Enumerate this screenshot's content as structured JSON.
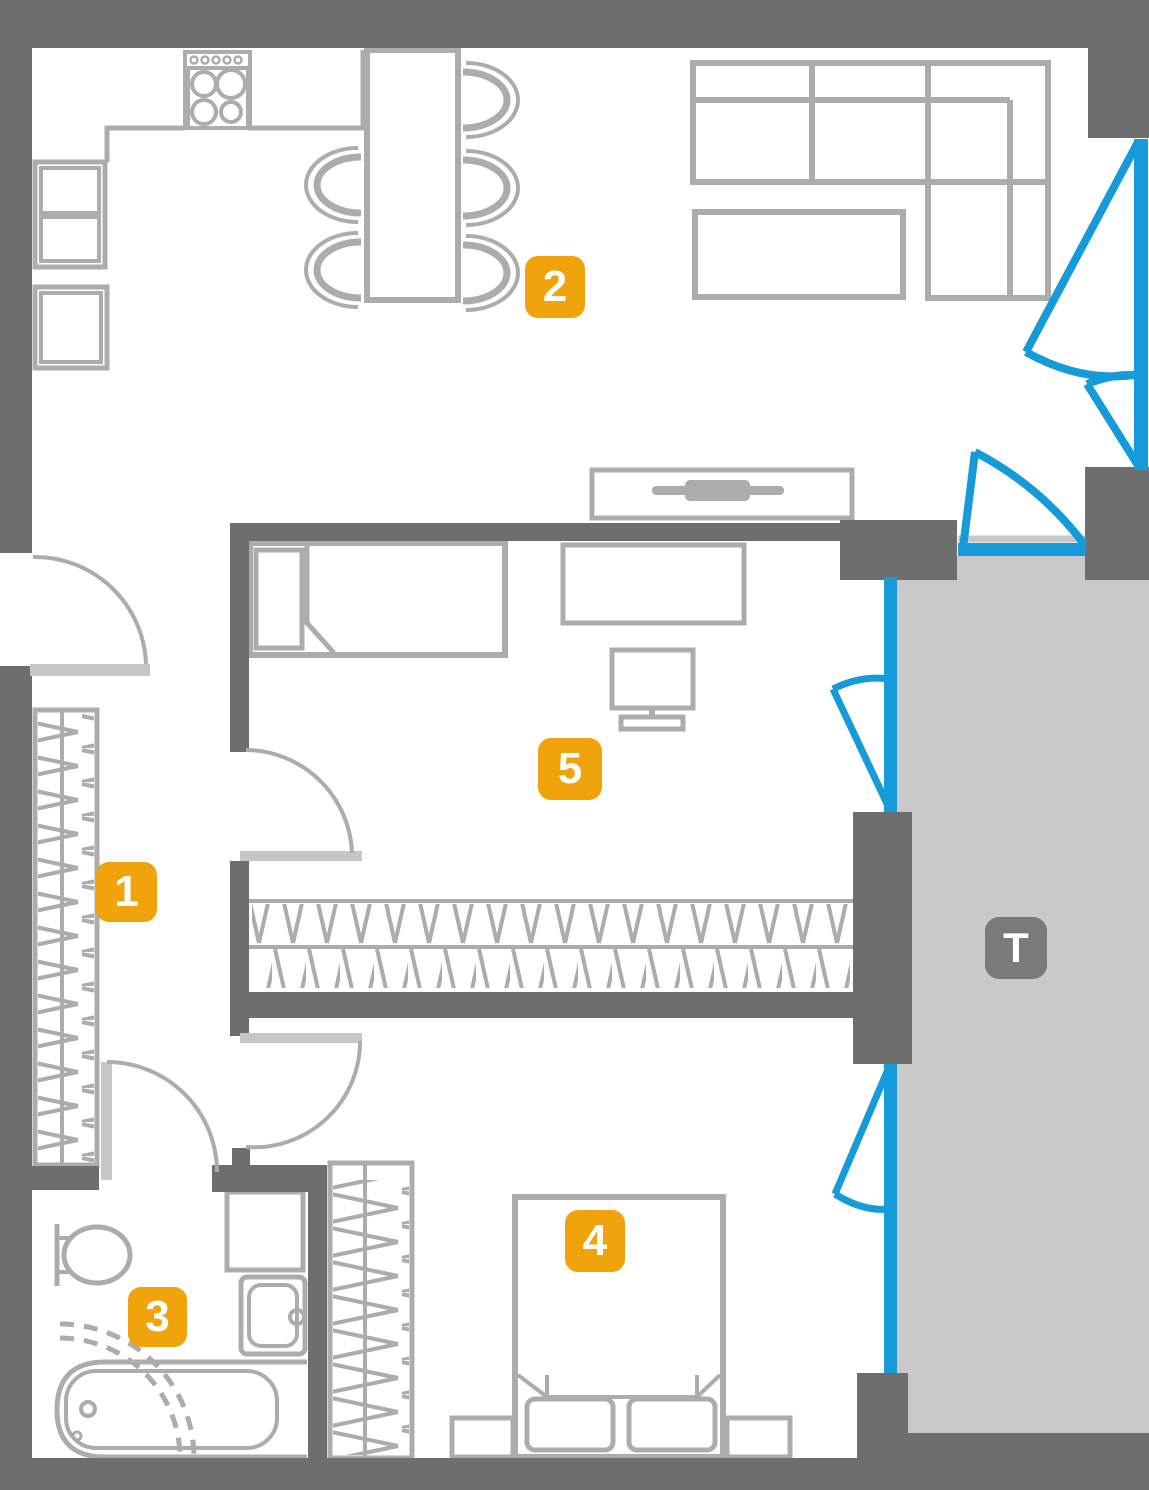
{
  "floor_plan": {
    "badges": {
      "room1": "1",
      "room2": "2",
      "room3": "3",
      "room4": "4",
      "room5": "5",
      "terrace": "T"
    },
    "colors": {
      "wall": "#6E6E6E",
      "furniture_line": "#ACACAC",
      "door_leaf": "#C6C6C6",
      "window_blue": "#159BD9",
      "terrace_floor": "#C9C9C9",
      "room_badge": "#F0A30A",
      "terrace_badge": "#7A7A7A",
      "badge_text": "#FFFFFF"
    }
  }
}
